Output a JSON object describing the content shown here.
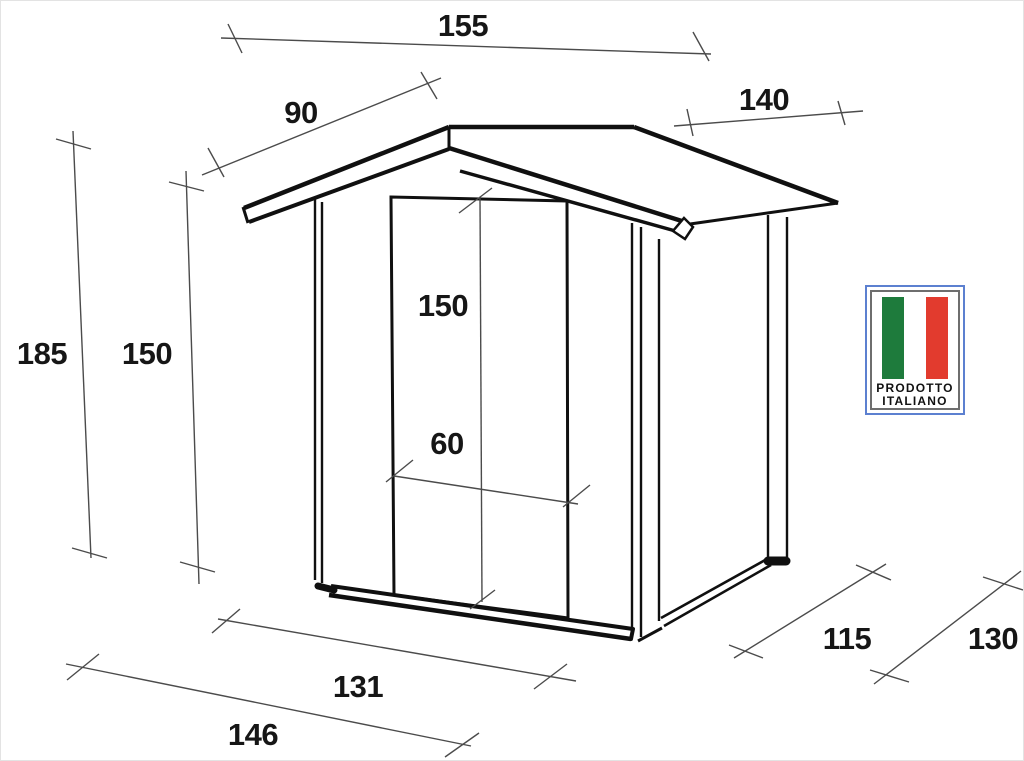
{
  "dimensions": {
    "roof_width": "155",
    "roof_slope_depth": "90",
    "roof_side_length": "140",
    "total_height": "185",
    "wall_height": "150",
    "door_height": "150",
    "door_width": "60",
    "floor_front_width": "131",
    "overall_front_width": "146",
    "floor_side_depth": "115",
    "overall_side_depth": "130"
  },
  "badge": {
    "line1": "PRODOTTO",
    "line2": "ITALIANO",
    "flag_green": "#1E7B3C",
    "flag_white": "#FFFFFF",
    "flag_red": "#E23B2E",
    "frame_blue": "#5C80D0",
    "frame_gray": "#6E6E6E"
  }
}
